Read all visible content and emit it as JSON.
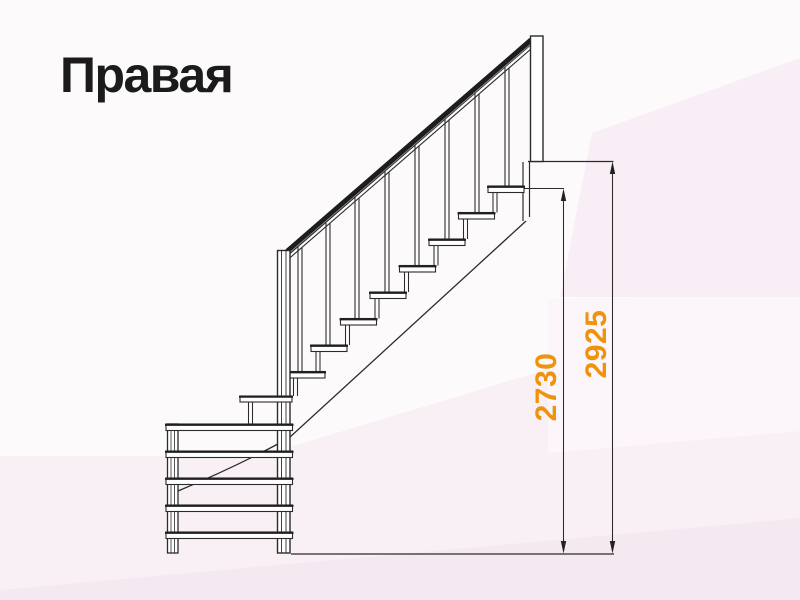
{
  "title": {
    "text": "Правая"
  },
  "dimensions": {
    "inner": {
      "value": "2730"
    },
    "outer": {
      "value": "2925"
    }
  },
  "colors": {
    "title_text": "#1B1B1B",
    "dimension_text": "#EF930F",
    "line_art": "#2B2B2B",
    "handrail_fill": "#1D1D1D",
    "background_base": "#FDFAFC",
    "background_pink_upper_right": "#F9EEF5",
    "background_pink_lower_band": "#F9F0F6",
    "background_pink_bottom_strip": "#F5E9F1"
  }
}
